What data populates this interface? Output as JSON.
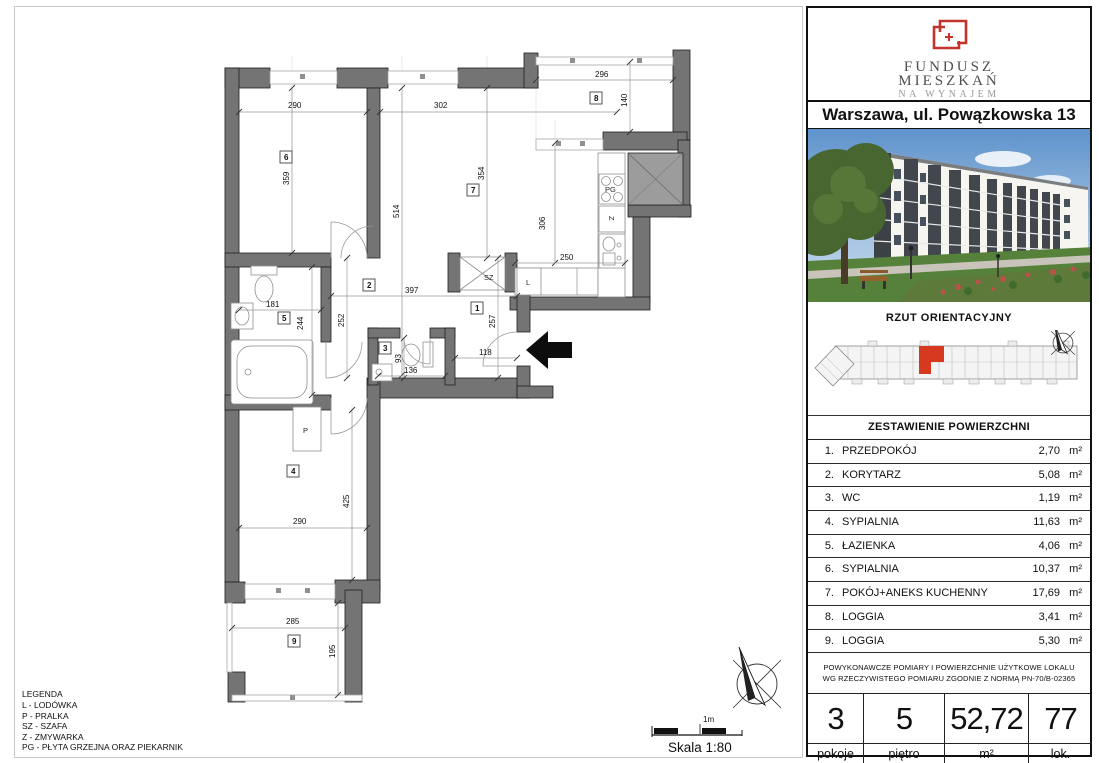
{
  "brand": {
    "line1": "FUNDUSZ",
    "line2": "MIESZKAŃ",
    "line3": "NA WYNAJEM"
  },
  "address": "Warszawa, ul. Powązkowska 13",
  "orientation_title": "RZUT ORIENTACYJNY",
  "table": {
    "title": "ZESTAWIENIE POWIERZCHNI",
    "unit": "m²",
    "rows": [
      {
        "num": "1.",
        "name": "PRZEDPOKÓJ",
        "area": "2,70"
      },
      {
        "num": "2.",
        "name": "KORYTARZ",
        "area": "5,08"
      },
      {
        "num": "3.",
        "name": "WC",
        "area": "1,19"
      },
      {
        "num": "4.",
        "name": "SYPIALNIA",
        "area": "11,63"
      },
      {
        "num": "5.",
        "name": "ŁAZIENKA",
        "area": "4,06"
      },
      {
        "num": "6.",
        "name": "SYPIALNIA",
        "area": "10,37"
      },
      {
        "num": "7.",
        "name": "POKÓJ+ANEKS KUCHENNY",
        "area": "17,69"
      },
      {
        "num": "8.",
        "name": "LOGGIA",
        "area": "3,41"
      },
      {
        "num": "9.",
        "name": "LOGGIA",
        "area": "5,30"
      }
    ]
  },
  "disclaimer": "POWYKONAWCZE POMIARY I POWIERZCHNIE UŻYTKOWE LOKALU WG RZECZYWISTEGO POMIARU ZGODNIE Z NORMĄ PN-70/B-02365",
  "stats": [
    {
      "value": "3",
      "label": "pokoje"
    },
    {
      "value": "5",
      "label": "piętro"
    },
    {
      "value": "52,72",
      "label": "m²"
    },
    {
      "value": "77",
      "label": "lok."
    }
  ],
  "legend": {
    "title": "LEGENDA",
    "items": [
      "L - LODÓWKA",
      "P - PRALKA",
      "SZ - SZAFA",
      "Z - ZMYWARKA",
      "PG - PŁYTA GRZEJNA ORAZ PIEKARNIK"
    ]
  },
  "scale": {
    "bar_label": "1m",
    "text": "Skala 1:80"
  },
  "plan": {
    "rooms": {
      "n1": "1",
      "n2": "2",
      "n3": "3",
      "n4": "4",
      "n5": "5",
      "n6": "6",
      "n7": "7",
      "n8": "8",
      "n9": "9"
    },
    "dims": {
      "r6w": "290",
      "r6h": "359",
      "r7w": "302",
      "r7l": "514",
      "r7h": "354",
      "l8w": "296",
      "l8h": "140",
      "kh": "306",
      "kw": "250",
      "c2": "397",
      "b5w": "181",
      "b5h": "244",
      "c2h": "252",
      "h1h": "257",
      "h1w": "118",
      "wch": "93",
      "wcw": "136",
      "r4l": "425",
      "r4w": "290",
      "l9w": "285",
      "l9h": "195"
    },
    "fixtures": {
      "p": "P",
      "l": "L",
      "sz": "SZ",
      "z": "Z",
      "pg": "PG"
    }
  },
  "colors": {
    "accent_red": "#c5342c",
    "unit_red": "#d6391f",
    "wall_gray": "#747474"
  }
}
